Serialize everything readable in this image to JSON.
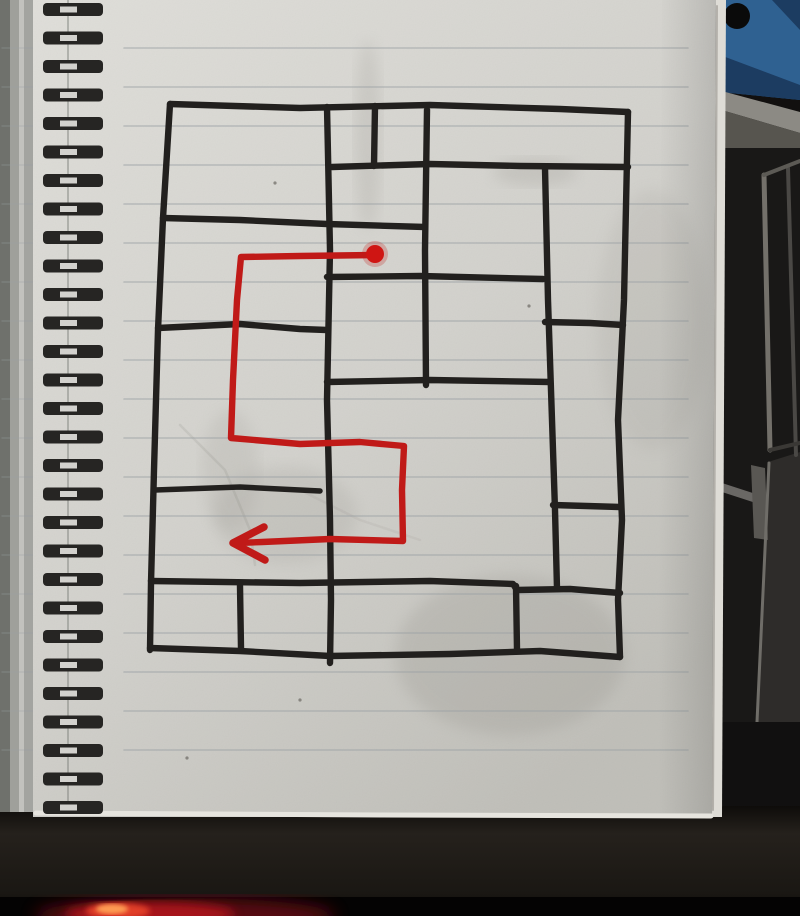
{
  "scene": {
    "width": 800,
    "height": 916
  },
  "colors": {
    "paper_light": "#dfded9",
    "paper_mid": "#d2d1cc",
    "paper_dark": "#bfbeb8",
    "rule_line": "#9aa0a4",
    "ink": "#22201e",
    "route_red": "#c01a18",
    "dot_red": "#cf1513",
    "coil_dark": "#262523",
    "coil_hole": "#d2d1cd",
    "wall_dark": "#12100f",
    "crate_blue": "#2f6191",
    "crate_blue_dark": "#1c3c61",
    "beam_top": "#8c8a84",
    "beam_front": "#57554f",
    "stain": "#8f8c85",
    "glow_outer": "#6e0c12",
    "glow_mid": "#b5121c",
    "glow_hot": "#e8452a",
    "glow_core": "#ffa054"
  },
  "background": {
    "crate": {
      "body": [
        [
          720,
          0
        ],
        [
          800,
          0
        ],
        [
          800,
          100
        ],
        [
          720,
          92
        ]
      ],
      "stripe1": [
        [
          720,
          55
        ],
        [
          800,
          85
        ],
        [
          800,
          100
        ],
        [
          720,
          92
        ]
      ],
      "stripe2": [
        [
          772,
          0
        ],
        [
          800,
          0
        ],
        [
          800,
          30
        ]
      ],
      "hole": {
        "cx": 737,
        "cy": 16,
        "r": 13,
        "color": "#0a0a0a"
      }
    },
    "beam": {
      "top": [
        [
          718,
          90
        ],
        [
          800,
          112
        ],
        [
          800,
          133
        ],
        [
          718,
          109
        ]
      ],
      "front": [
        [
          718,
          109
        ],
        [
          800,
          133
        ],
        [
          800,
          171
        ],
        [
          718,
          149
        ]
      ],
      "shadow": [
        [
          718,
          149
        ],
        [
          800,
          171
        ],
        [
          800,
          180
        ],
        [
          718,
          157
        ]
      ]
    },
    "lower_wall": {
      "x": 716,
      "y": 148,
      "w": 84,
      "h": 672,
      "color": "#191817"
    },
    "panels": [
      {
        "pts": [
          [
            768,
            462
          ],
          [
            800,
            452
          ],
          [
            800,
            728
          ],
          [
            756,
            722
          ]
        ],
        "c": "#2e2c2a"
      },
      {
        "pts": [
          [
            722,
            483
          ],
          [
            762,
            496
          ],
          [
            762,
            505
          ],
          [
            722,
            492
          ]
        ],
        "c": "#6a6865"
      },
      {
        "pts": [
          [
            751,
            465
          ],
          [
            765,
            468
          ],
          [
            768,
            540
          ],
          [
            754,
            538
          ]
        ],
        "c": "#595753"
      }
    ],
    "frame_lines": [
      {
        "pts": [
          [
            764,
            175
          ],
          [
            770,
            450
          ]
        ],
        "c": "#73706a",
        "w": 5
      },
      {
        "pts": [
          [
            788,
            168
          ],
          [
            796,
            455
          ]
        ],
        "c": "#4a4845",
        "w": 4
      },
      {
        "pts": [
          [
            764,
            175
          ],
          [
            800,
            161
          ]
        ],
        "c": "#5c5a55",
        "w": 4
      },
      {
        "pts": [
          [
            770,
            450
          ],
          [
            800,
            443
          ]
        ],
        "c": "#3a3835",
        "w": 4
      },
      {
        "pts": [
          [
            769,
            463
          ],
          [
            757,
            722
          ]
        ],
        "c": "#6f6d68",
        "w": 3
      }
    ],
    "floor": {
      "x": 716,
      "y": 722,
      "w": 84,
      "h": 98,
      "color": "#111010"
    }
  },
  "desk": {
    "band": {
      "x": 0,
      "y": 806,
      "w": 800,
      "h": 110
    },
    "black_strip": {
      "x": 0,
      "y": 897,
      "w": 800,
      "h": 19,
      "color": "#040303"
    },
    "glow": [
      {
        "cx": 185,
        "cy": 916,
        "rx": 150,
        "ry": 18,
        "fill": "#6e0c12",
        "op": 0.8,
        "blur": "b8"
      },
      {
        "cx": 150,
        "cy": 914,
        "rx": 85,
        "ry": 12,
        "fill": "#b5121c",
        "op": 0.85,
        "blur": "b5"
      },
      {
        "cx": 118,
        "cy": 911,
        "rx": 32,
        "ry": 8,
        "fill": "#e8452a",
        "op": 0.9,
        "blur": "b3"
      },
      {
        "cx": 112,
        "cy": 909,
        "rx": 16,
        "ry": 5,
        "fill": "#ffa054",
        "op": 0.95,
        "blur": "b2"
      }
    ]
  },
  "notebook": {
    "cover_strips": [
      {
        "x": 0,
        "w": 10,
        "c": "#6f716c"
      },
      {
        "x": 10,
        "w": 9,
        "c": "#9fa09b"
      },
      {
        "x": 19,
        "w": 5,
        "c": "#c2c2be"
      },
      {
        "x": 24,
        "w": 9,
        "c": "#a3a4a0"
      }
    ],
    "cover_h": 812,
    "page_poly": [
      [
        33,
        0
      ],
      [
        716,
        0
      ],
      [
        712,
        817
      ],
      [
        33,
        817
      ]
    ],
    "edge_shade": [
      [
        662,
        0
      ],
      [
        716,
        0
      ],
      [
        712,
        817
      ],
      [
        658,
        817
      ]
    ],
    "edge_strip": [
      [
        716,
        0
      ],
      [
        726,
        0
      ],
      [
        722,
        817
      ],
      [
        712,
        817
      ]
    ],
    "edge_line": {
      "pts": [
        [
          717,
          6
        ],
        [
          713,
          810
        ]
      ],
      "c": "#8f8d87",
      "w": 2,
      "op": 0.55
    },
    "bottom_edge": {
      "pts": [
        [
          36,
          813
        ],
        [
          380,
          815
        ],
        [
          711,
          816
        ]
      ],
      "c": "#e6e4de",
      "w": 5
    },
    "seam": {
      "x": 68,
      "y1": 0,
      "y2": 810,
      "c": "#7c7e7a"
    },
    "rules": {
      "x_start": 124,
      "x_end": 688,
      "y_start": 48,
      "spacing": 39,
      "count": 19,
      "tick_x1": 2,
      "tick_x2": 34
    },
    "coils": {
      "x": 43,
      "w": 60,
      "h": 13,
      "hole_x": 60,
      "hole_w": 17,
      "y_start": 3,
      "spacing": 28.5,
      "count": 29
    },
    "stains": [
      {
        "cx": 368,
        "cy": 135,
        "rx": 13,
        "ry": 95,
        "op": 0.18
      },
      {
        "cx": 535,
        "cy": 172,
        "rx": 42,
        "ry": 14,
        "op": 0.2
      },
      {
        "cx": 510,
        "cy": 655,
        "rx": 115,
        "ry": 80,
        "op": 0.22
      },
      {
        "cx": 285,
        "cy": 515,
        "rx": 72,
        "ry": 48,
        "op": 0.16
      },
      {
        "cx": 652,
        "cy": 320,
        "rx": 55,
        "ry": 130,
        "op": 0.12
      },
      {
        "cx": 230,
        "cy": 470,
        "rx": 28,
        "ry": 60,
        "op": 0.14
      }
    ],
    "creases": [
      {
        "pts": [
          [
            180,
            425
          ],
          [
            225,
            470
          ],
          [
            250,
            530
          ],
          [
            255,
            565
          ]
        ],
        "op": 0.12
      },
      {
        "pts": [
          [
            300,
            490
          ],
          [
            360,
            520
          ],
          [
            420,
            540
          ]
        ],
        "op": 0.08
      }
    ],
    "specks": [
      [
        275,
        183
      ],
      [
        300,
        700
      ],
      [
        187,
        758
      ],
      [
        529,
        306
      ]
    ]
  },
  "map": {
    "ink_width": 6.4,
    "walls": [
      {
        "pts": [
          [
            170,
            104
          ],
          [
            300,
            108
          ],
          [
            430,
            105
          ],
          [
            560,
            109
          ],
          [
            628,
            112
          ]
        ]
      },
      {
        "pts": [
          [
            170,
            104
          ],
          [
            163,
            218
          ],
          [
            158,
            330
          ],
          [
            154,
            470
          ],
          [
            151,
            583
          ],
          [
            150,
            650
          ]
        ]
      },
      {
        "pts": [
          [
            150,
            648
          ],
          [
            240,
            651
          ],
          [
            330,
            656
          ],
          [
            450,
            654
          ],
          [
            540,
            651
          ],
          [
            620,
            657
          ]
        ]
      },
      {
        "pts": [
          [
            628,
            112
          ],
          [
            624,
            300
          ],
          [
            618,
            420
          ],
          [
            622,
            520
          ],
          [
            618,
            600
          ],
          [
            620,
            657
          ]
        ]
      },
      {
        "pts": [
          [
            327,
            107
          ],
          [
            330,
            250
          ],
          [
            327,
            400
          ],
          [
            330,
            520
          ],
          [
            331,
            600
          ],
          [
            330,
            663
          ]
        ]
      },
      {
        "pts": [
          [
            375,
            106
          ],
          [
            374,
            166
          ]
        ]
      },
      {
        "pts": [
          [
            427,
            110
          ],
          [
            425,
            250
          ],
          [
            426,
            385
          ]
        ]
      },
      {
        "pts": [
          [
            545,
            168
          ],
          [
            548,
            300
          ],
          [
            552,
            420
          ],
          [
            555,
            510
          ],
          [
            557,
            589
          ]
        ]
      },
      {
        "pts": [
          [
            240,
            586
          ],
          [
            241,
            648
          ]
        ]
      },
      {
        "pts": [
          [
            516,
            586
          ],
          [
            517,
            650
          ]
        ]
      },
      {
        "pts": [
          [
            332,
            167
          ],
          [
            430,
            164
          ],
          [
            520,
            166
          ],
          [
            628,
            167
          ]
        ]
      },
      {
        "pts": [
          [
            163,
            218
          ],
          [
            240,
            220
          ],
          [
            327,
            224
          ],
          [
            425,
            227
          ]
        ]
      },
      {
        "pts": [
          [
            327,
            277
          ],
          [
            420,
            276
          ],
          [
            543,
            279
          ]
        ]
      },
      {
        "pts": [
          [
            545,
            322
          ],
          [
            590,
            323
          ],
          [
            623,
            325
          ]
        ]
      },
      {
        "pts": [
          [
            327,
            382
          ],
          [
            430,
            380
          ],
          [
            550,
            382
          ]
        ]
      },
      {
        "pts": [
          [
            158,
            328
          ],
          [
            240,
            324
          ],
          [
            300,
            329
          ],
          [
            327,
            330
          ]
        ]
      },
      {
        "pts": [
          [
            155,
            490
          ],
          [
            240,
            487
          ],
          [
            320,
            491
          ]
        ],
        "w": 5.5
      },
      {
        "pts": [
          [
            553,
            505
          ],
          [
            620,
            507
          ]
        ]
      },
      {
        "pts": [
          [
            151,
            581
          ],
          [
            300,
            583
          ],
          [
            430,
            581
          ],
          [
            513,
            584
          ],
          [
            517,
            590
          ],
          [
            570,
            589
          ],
          [
            620,
            593
          ]
        ]
      }
    ],
    "route": {
      "width": 6.4,
      "points": [
        [
          375,
          255
        ],
        [
          300,
          256
        ],
        [
          241,
          257
        ],
        [
          237,
          300
        ],
        [
          233,
          380
        ],
        [
          231,
          438
        ],
        [
          300,
          444
        ],
        [
          360,
          442
        ],
        [
          404,
          446
        ],
        [
          402,
          490
        ],
        [
          403,
          541
        ],
        [
          330,
          539
        ],
        [
          262,
          542
        ],
        [
          238,
          543
        ]
      ],
      "start_dot": {
        "cx": 375,
        "cy": 254,
        "r": 9
      },
      "arrowhead": {
        "pts": [
          [
            264,
            527
          ],
          [
            233,
            543
          ],
          [
            265,
            560
          ]
        ],
        "width": 7.5
      }
    }
  }
}
